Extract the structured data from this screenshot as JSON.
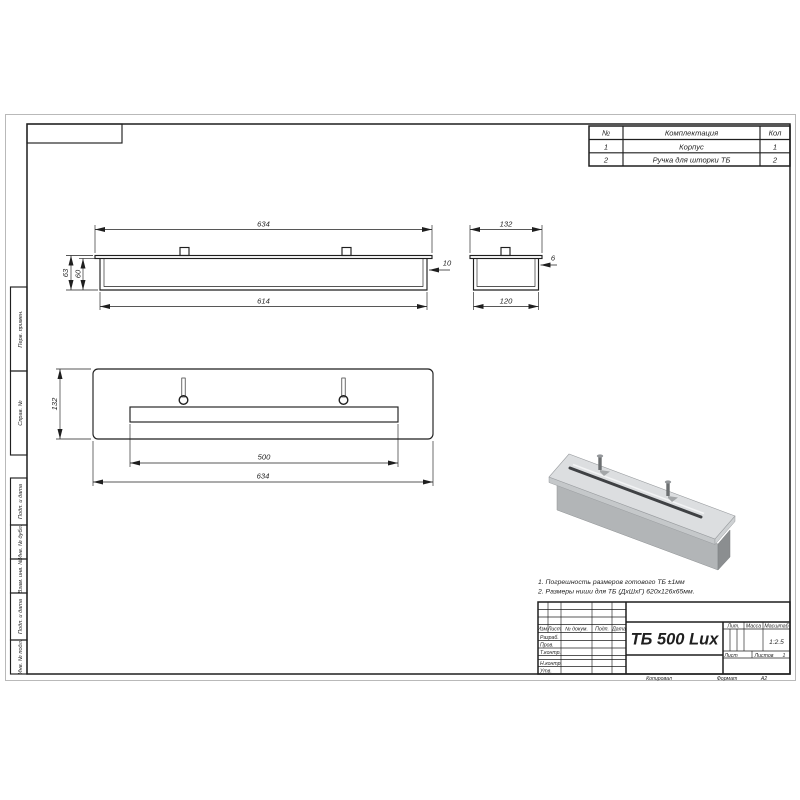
{
  "sheet": {
    "copied_label": "Копировал",
    "format_label": "Формат",
    "format_value": "А2"
  },
  "parts_table": {
    "headers": {
      "num": "№",
      "name": "Комплектация",
      "qty": "Кол"
    },
    "rows": [
      {
        "num": "1",
        "name": "Корпус",
        "qty": "1"
      },
      {
        "num": "2",
        "name": "Ручка для шторки ТБ",
        "qty": "2"
      }
    ]
  },
  "notes": {
    "line1": "1. Погрешность размеров готового ТБ ±1мм",
    "line2": "2. Размеры ниши для ТБ (ДхШхГ) 620х126х65мм."
  },
  "margin_labels": {
    "perv_primen": "Перв. примен.",
    "sprav_no": "Справ. №",
    "podp_data_1": "Подп. и дата",
    "inv_dubl": "Инв. № дубл.",
    "vzam_inv": "Взам. инв. №",
    "podp_data_2": "Подп. и дата",
    "inv_podl": "Инв. № подл."
  },
  "views": {
    "front": {
      "dim_width_top": "634",
      "dim_width_bottom": "614",
      "dim_height_outer": "63",
      "dim_height_inner": "60",
      "dim_lip": "10"
    },
    "side": {
      "dim_width_top": "132",
      "dim_width_bottom": "120",
      "dim_wall": "6"
    },
    "top": {
      "dim_height": "132",
      "dim_slot": "500",
      "dim_width": "634"
    }
  },
  "title_block": {
    "doc_name": "ТБ 500 Lux",
    "cols": {
      "izm": "Изм.",
      "list": "Лист",
      "no_doc": "№ докум.",
      "podp": "Подп.",
      "data": "Дата"
    },
    "rows": {
      "razrab": "Разраб.",
      "prov": "Пров.",
      "t_contr": "Т.контр.",
      "n_contr": "Н.контр.",
      "utv": "Утв."
    },
    "right": {
      "lit": "Лит.",
      "massa": "Масса",
      "masshtab": "Масштаб",
      "scale_value": "1:2.5",
      "list": "Лист",
      "listov": "Листов",
      "listov_value": "1"
    }
  }
}
